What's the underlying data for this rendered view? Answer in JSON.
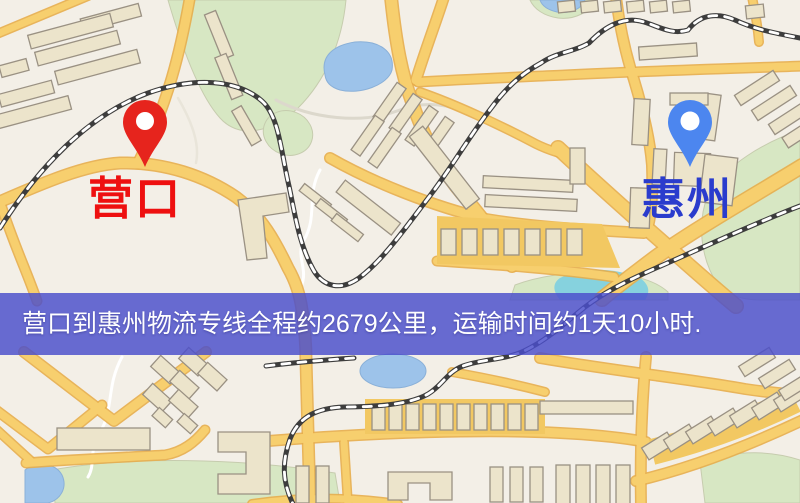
{
  "map": {
    "labels": {
      "origin": "营口",
      "destination": "惠州"
    },
    "banner": {
      "text": "营口到惠州物流专线全程约2679公里，运输时间约1天10小时.",
      "background": "#4a4ecb",
      "text_color": "#ffffff"
    },
    "markers": {
      "origin": {
        "icon": "red-location-pin-icon",
        "color": "#e6241d",
        "hole_color": "#ffffff"
      },
      "destination": {
        "icon": "blue-location-pin-icon",
        "color": "#4c86ef",
        "hole_color": "#ffffff"
      }
    },
    "palette": {
      "background": "#f3efe7",
      "road_fill": "#f7cf6e",
      "road_casing": "#e7ad4b",
      "water": "#9dc3ea",
      "park": "#d7e7c3",
      "building": "#ece4cb",
      "building_outline": "#9a9183",
      "railway": "#3d3d3d",
      "origin_label_color": "#ee1010",
      "destination_label_color": "#2a3ccd"
    }
  },
  "route_info": {
    "origin": "营口",
    "destination": "惠州",
    "distance_text": "全程约2679公里",
    "duration_text": "运输时间约1天10小时"
  }
}
